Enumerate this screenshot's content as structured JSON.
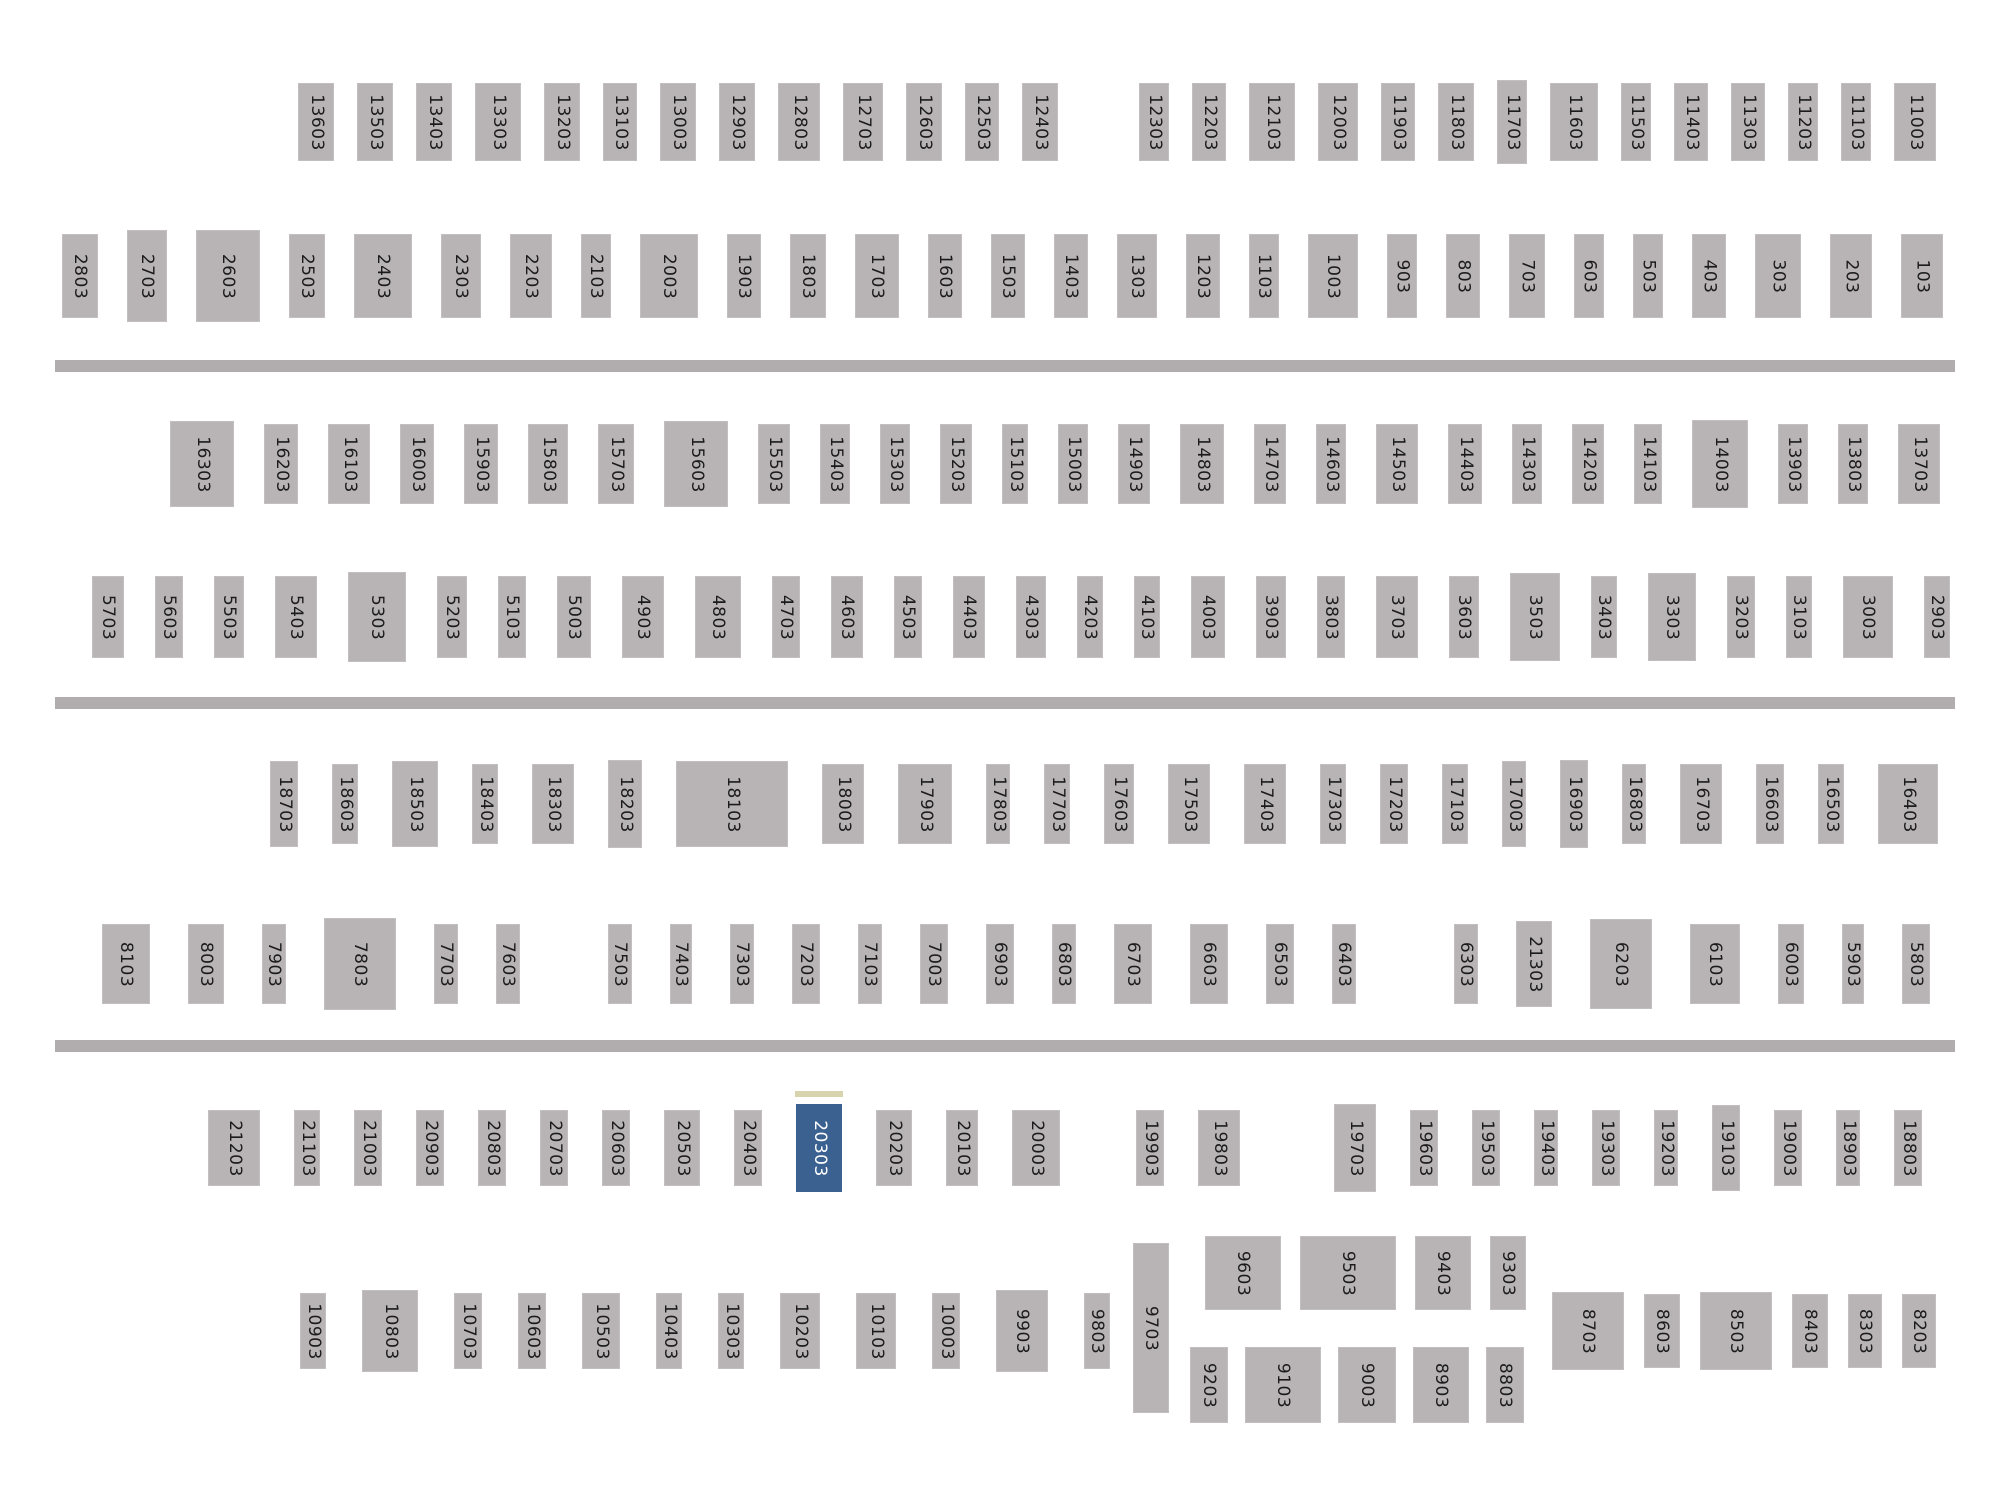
{
  "title": "lot-selection-map",
  "selected_lot": "20303",
  "colors": {
    "background": "#ffffff",
    "block": "#b8b3b4",
    "block_border": "#c3bebf",
    "divider": "#b1acae",
    "label": "#1b1b1b",
    "selected": "#3b6191",
    "selected_text": "#ffffff",
    "selected_marker": "#d8d4ad"
  },
  "map": {
    "dividers": [
      {
        "top": 360
      },
      {
        "top": 697
      },
      {
        "top": 1040
      }
    ],
    "rows": [
      {
        "name": "lot-row-1",
        "left": 298,
        "top": 80,
        "gap": 23,
        "w": 36,
        "h": 78,
        "blocks": [
          {
            "label": "13603"
          },
          {
            "label": "13503"
          },
          {
            "label": "13403"
          },
          {
            "label": "13303",
            "w": 46
          },
          {
            "label": "13203"
          },
          {
            "label": "13103",
            "w": 34
          },
          {
            "label": "13003"
          },
          {
            "label": "12903"
          },
          {
            "label": "12803",
            "w": 42
          },
          {
            "label": "12703",
            "w": 40
          },
          {
            "label": "12603"
          },
          {
            "label": "12503",
            "w": 34
          },
          {
            "label": "12403"
          },
          {
            "label": "12303",
            "w": 30,
            "ml": 58
          },
          {
            "label": "12203",
            "w": 34
          },
          {
            "label": "12103",
            "w": 46
          },
          {
            "label": "12003",
            "w": 40
          },
          {
            "label": "11903",
            "w": 34
          },
          {
            "label": "11803"
          },
          {
            "label": "11703",
            "w": 30,
            "h": 84
          },
          {
            "label": "11603",
            "w": 48
          },
          {
            "label": "11503",
            "w": 30
          },
          {
            "label": "11403",
            "w": 34
          },
          {
            "label": "11303",
            "w": 34
          },
          {
            "label": "11203",
            "w": 30
          },
          {
            "label": "11103",
            "w": 30
          },
          {
            "label": "11003",
            "w": 42
          }
        ]
      },
      {
        "name": "lot-row-2",
        "left": 62,
        "top": 230,
        "gap": 29,
        "w": 38,
        "h": 84,
        "blocks": [
          {
            "label": "2803",
            "w": 36
          },
          {
            "label": "2703",
            "w": 40,
            "h": 92
          },
          {
            "label": "2603",
            "w": 64,
            "h": 92
          },
          {
            "label": "2503",
            "w": 36
          },
          {
            "label": "2403",
            "w": 58
          },
          {
            "label": "2303",
            "w": 40
          },
          {
            "label": "2203",
            "w": 42
          },
          {
            "label": "2103",
            "w": 30
          },
          {
            "label": "2003",
            "w": 58
          },
          {
            "label": "1903",
            "w": 34
          },
          {
            "label": "1803",
            "w": 36
          },
          {
            "label": "1703",
            "w": 44
          },
          {
            "label": "1603",
            "w": 34
          },
          {
            "label": "1503",
            "w": 34
          },
          {
            "label": "1403",
            "w": 34
          },
          {
            "label": "1303",
            "w": 40
          },
          {
            "label": "1203",
            "w": 34
          },
          {
            "label": "1103",
            "w": 30
          },
          {
            "label": "1003",
            "w": 50
          },
          {
            "label": "903",
            "w": 30
          },
          {
            "label": "803",
            "w": 34
          },
          {
            "label": "703",
            "w": 36
          },
          {
            "label": "603",
            "w": 30
          },
          {
            "label": "503",
            "w": 30
          },
          {
            "label": "403",
            "w": 34
          },
          {
            "label": "303",
            "w": 46
          },
          {
            "label": "203",
            "w": 42
          },
          {
            "label": "103",
            "w": 42
          }
        ]
      },
      {
        "name": "lot-row-3",
        "left": 170,
        "top": 420,
        "gap": 30,
        "w": 34,
        "h": 80,
        "blocks": [
          {
            "label": "16303",
            "w": 64,
            "h": 86
          },
          {
            "label": "16203"
          },
          {
            "label": "16103",
            "w": 42
          },
          {
            "label": "16003"
          },
          {
            "label": "15903"
          },
          {
            "label": "15803",
            "w": 40
          },
          {
            "label": "15703",
            "w": 36
          },
          {
            "label": "15603",
            "w": 64,
            "h": 86
          },
          {
            "label": "15503",
            "w": 32
          },
          {
            "label": "15403",
            "w": 30
          },
          {
            "label": "15303",
            "w": 30
          },
          {
            "label": "15203",
            "w": 32
          },
          {
            "label": "15103",
            "w": 26
          },
          {
            "label": "15003",
            "w": 30
          },
          {
            "label": "14903",
            "w": 32
          },
          {
            "label": "14803",
            "w": 44
          },
          {
            "label": "14703",
            "w": 32
          },
          {
            "label": "14603",
            "w": 30
          },
          {
            "label": "14503",
            "w": 42
          },
          {
            "label": "14403"
          },
          {
            "label": "14303",
            "w": 30
          },
          {
            "label": "14203",
            "w": 32
          },
          {
            "label": "14103",
            "w": 28
          },
          {
            "label": "14003",
            "w": 56,
            "h": 88
          },
          {
            "label": "13903",
            "w": 30
          },
          {
            "label": "13803",
            "w": 30
          },
          {
            "label": "13703",
            "w": 42
          }
        ]
      },
      {
        "name": "lot-row-4",
        "left": 92,
        "top": 572,
        "gap": 31,
        "w": 30,
        "h": 82,
        "blocks": [
          {
            "label": "5703",
            "w": 32
          },
          {
            "label": "5603",
            "w": 28
          },
          {
            "label": "5503"
          },
          {
            "label": "5403",
            "w": 42
          },
          {
            "label": "5303",
            "w": 58,
            "h": 90
          },
          {
            "label": "5203"
          },
          {
            "label": "5103",
            "w": 28
          },
          {
            "label": "5003",
            "w": 34
          },
          {
            "label": "4903",
            "w": 42
          },
          {
            "label": "4803",
            "w": 46
          },
          {
            "label": "4703",
            "w": 28
          },
          {
            "label": "4603",
            "w": 32
          },
          {
            "label": "4503",
            "w": 28
          },
          {
            "label": "4403",
            "w": 32
          },
          {
            "label": "4303"
          },
          {
            "label": "4203",
            "w": 26
          },
          {
            "label": "4103",
            "w": 26
          },
          {
            "label": "4003",
            "w": 34
          },
          {
            "label": "3903"
          },
          {
            "label": "3803",
            "w": 28
          },
          {
            "label": "3703",
            "w": 42
          },
          {
            "label": "3603"
          },
          {
            "label": "3503",
            "w": 50,
            "h": 88
          },
          {
            "label": "3403",
            "w": 26
          },
          {
            "label": "3303",
            "w": 48,
            "h": 88
          },
          {
            "label": "3203",
            "w": 28
          },
          {
            "label": "3103",
            "w": 26
          },
          {
            "label": "3003",
            "w": 50
          },
          {
            "label": "2903",
            "w": 26
          }
        ]
      },
      {
        "name": "lot-row-5",
        "left": 270,
        "top": 760,
        "gap": 34,
        "w": 30,
        "h": 80,
        "blocks": [
          {
            "label": "18703",
            "w": 28,
            "h": 86
          },
          {
            "label": "18603",
            "w": 26
          },
          {
            "label": "18503",
            "w": 46,
            "h": 86
          },
          {
            "label": "18403",
            "w": 26
          },
          {
            "label": "18303",
            "w": 42
          },
          {
            "label": "18203",
            "w": 34,
            "h": 88
          },
          {
            "label": "18103",
            "w": 112,
            "h": 86
          },
          {
            "label": "18003",
            "w": 42
          },
          {
            "label": "17903",
            "w": 54
          },
          {
            "label": "17803",
            "w": 24
          },
          {
            "label": "17703",
            "w": 26
          },
          {
            "label": "17603"
          },
          {
            "label": "17503",
            "w": 42
          },
          {
            "label": "17403",
            "w": 42
          },
          {
            "label": "17303",
            "w": 26
          },
          {
            "label": "17203",
            "w": 28
          },
          {
            "label": "17103",
            "w": 26
          },
          {
            "label": "17003",
            "w": 24,
            "h": 86
          },
          {
            "label": "16903",
            "w": 28,
            "h": 88
          },
          {
            "label": "16803",
            "w": 24
          },
          {
            "label": "16703",
            "w": 42
          },
          {
            "label": "16603",
            "w": 28
          },
          {
            "label": "16503",
            "w": 26
          },
          {
            "label": "16403",
            "w": 60
          }
        ]
      },
      {
        "name": "lot-row-6",
        "left": 102,
        "top": 918,
        "gap": 38,
        "w": 26,
        "h": 80,
        "blocks": [
          {
            "label": "8103",
            "w": 48
          },
          {
            "label": "8003",
            "w": 36
          },
          {
            "label": "7903",
            "w": 24
          },
          {
            "label": "7803",
            "w": 72,
            "h": 92
          },
          {
            "label": "7703",
            "w": 24
          },
          {
            "label": "7603",
            "w": 24
          },
          {
            "label": "7503",
            "w": 24,
            "ml": 50
          },
          {
            "label": "7403",
            "w": 22
          },
          {
            "label": "7303",
            "w": 24
          },
          {
            "label": "7203",
            "w": 28
          },
          {
            "label": "7103",
            "w": 24
          },
          {
            "label": "7003",
            "w": 28
          },
          {
            "label": "6903",
            "w": 28
          },
          {
            "label": "6803",
            "w": 24
          },
          {
            "label": "6703",
            "w": 38
          },
          {
            "label": "6603",
            "w": 38
          },
          {
            "label": "6503",
            "w": 28
          },
          {
            "label": "6403",
            "w": 24
          },
          {
            "label": "6303",
            "w": 24,
            "ml": 60
          },
          {
            "label": "21303",
            "w": 36,
            "h": 86
          },
          {
            "label": "6203",
            "w": 62,
            "h": 90
          },
          {
            "label": "6103",
            "w": 50
          },
          {
            "label": "6003",
            "w": 26
          },
          {
            "label": "5903",
            "w": 22
          },
          {
            "label": "5803",
            "w": 28
          }
        ]
      },
      {
        "name": "lot-row-7",
        "left": 208,
        "top": 1104,
        "gap": 34,
        "w": 28,
        "h": 76,
        "blocks": [
          {
            "label": "21203",
            "w": 52
          },
          {
            "label": "21103",
            "w": 26
          },
          {
            "label": "21003"
          },
          {
            "label": "20903"
          },
          {
            "label": "20803"
          },
          {
            "label": "20703"
          },
          {
            "label": "20603"
          },
          {
            "label": "20503",
            "w": 36
          },
          {
            "label": "20403"
          },
          {
            "label": "20303",
            "w": 46,
            "h": 88,
            "selected": true
          },
          {
            "label": "20203",
            "w": 36
          },
          {
            "label": "20103",
            "w": 32
          },
          {
            "label": "20003",
            "w": 48
          },
          {
            "label": "19903",
            "ml": 42
          },
          {
            "label": "19803",
            "w": 42
          },
          {
            "label": "19703",
            "w": 42,
            "h": 88,
            "ml": 60
          },
          {
            "label": "19603"
          },
          {
            "label": "19503"
          },
          {
            "label": "19403",
            "w": 24
          },
          {
            "label": "19303"
          },
          {
            "label": "19203",
            "w": 24
          },
          {
            "label": "19103",
            "h": 86
          },
          {
            "label": "19003"
          },
          {
            "label": "18903",
            "w": 24
          },
          {
            "label": "18803"
          }
        ]
      },
      {
        "name": "lot-row-8-left",
        "left": 300,
        "top": 1290,
        "gap": 36,
        "w": 28,
        "h": 76,
        "blocks": [
          {
            "label": "10903",
            "w": 26
          },
          {
            "label": "10803",
            "w": 56,
            "h": 82
          },
          {
            "label": "10703"
          },
          {
            "label": "10603"
          },
          {
            "label": "10503",
            "w": 38
          },
          {
            "label": "10403",
            "w": 26
          },
          {
            "label": "10303",
            "w": 26
          },
          {
            "label": "10203",
            "w": 40
          },
          {
            "label": "10103",
            "w": 40
          },
          {
            "label": "10003"
          },
          {
            "label": "9903",
            "w": 52,
            "h": 82
          },
          {
            "label": "9803",
            "w": 26
          }
        ]
      },
      {
        "name": "lot-row-8-tall",
        "left": 1133,
        "top": 1243,
        "gap": 0,
        "w": 36,
        "h": 170,
        "blocks": [
          {
            "label": "9703"
          }
        ]
      },
      {
        "name": "lot-row-8-center-top",
        "left": 1205,
        "top": 1236,
        "gap": 19,
        "w": 56,
        "h": 74,
        "blocks": [
          {
            "label": "9603",
            "w": 76
          },
          {
            "label": "9503",
            "w": 96
          },
          {
            "label": "9403",
            "w": 56
          },
          {
            "label": "9303",
            "w": 36
          }
        ]
      },
      {
        "name": "lot-row-8-center-bottom",
        "left": 1190,
        "top": 1347,
        "gap": 17,
        "w": 56,
        "h": 76,
        "blocks": [
          {
            "label": "9203",
            "w": 38
          },
          {
            "label": "9103",
            "w": 76
          },
          {
            "label": "9003",
            "w": 58
          },
          {
            "label": "8903",
            "w": 56
          },
          {
            "label": "8803",
            "w": 38
          }
        ]
      },
      {
        "name": "lot-row-8-right",
        "left": 1552,
        "top": 1292,
        "gap": 20,
        "w": 36,
        "h": 74,
        "blocks": [
          {
            "label": "8703",
            "w": 72,
            "h": 78
          },
          {
            "label": "8603"
          },
          {
            "label": "8503",
            "w": 72,
            "h": 78
          },
          {
            "label": "8403"
          },
          {
            "label": "8303",
            "w": 34
          },
          {
            "label": "8203",
            "w": 34
          }
        ]
      }
    ]
  }
}
